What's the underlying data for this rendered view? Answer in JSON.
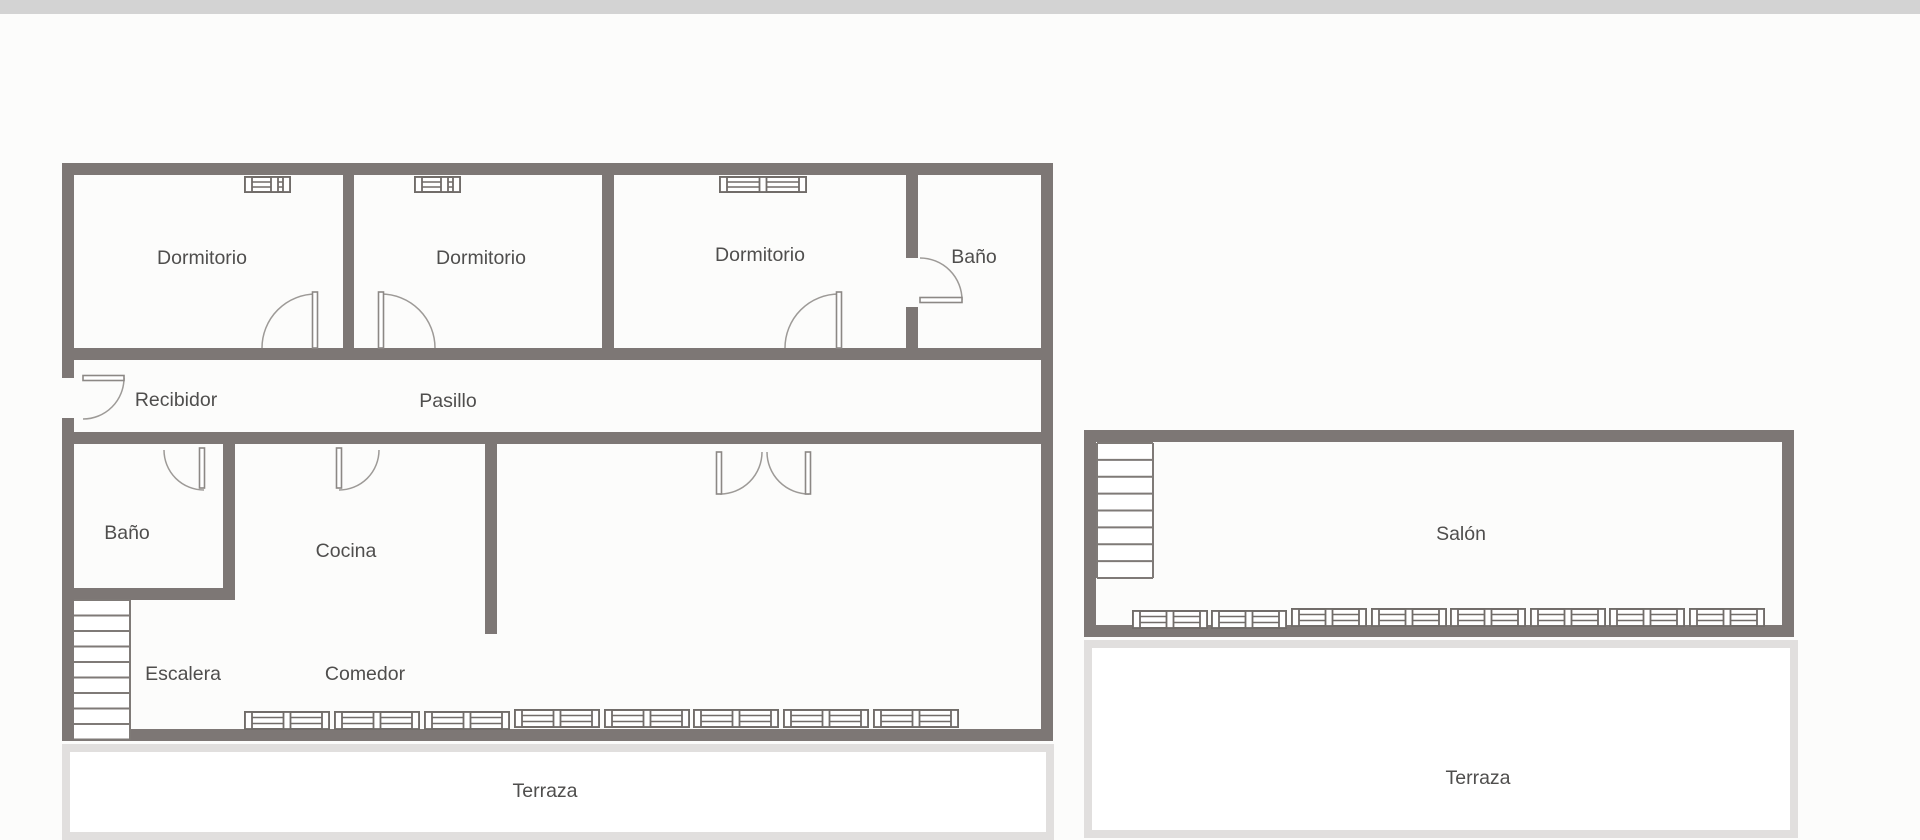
{
  "page": {
    "background_color": "#fcfcfb",
    "topbar_color": "#d3d3d3"
  },
  "plan": {
    "type": "floor-plan",
    "wall_color": "#7d7775",
    "symbol_color": "#716c69",
    "door_arc_color": "#9d9a97",
    "terrace_border_color": "#e1dfde",
    "label_color": "#4f4e4d",
    "labels": {
      "dormitorio1": "Dormitorio",
      "dormitorio2": "Dormitorio",
      "dormitorio3": "Dormitorio",
      "bano_top": "Baño",
      "recibidor": "Recibidor",
      "pasillo": "Pasillo",
      "bano_bottom": "Baño",
      "cocina": "Cocina",
      "escalera": "Escalera",
      "comedor": "Comedor",
      "terraza_main": "Terraza",
      "salon": "Salón",
      "terraza_salon": "Terraza"
    }
  }
}
